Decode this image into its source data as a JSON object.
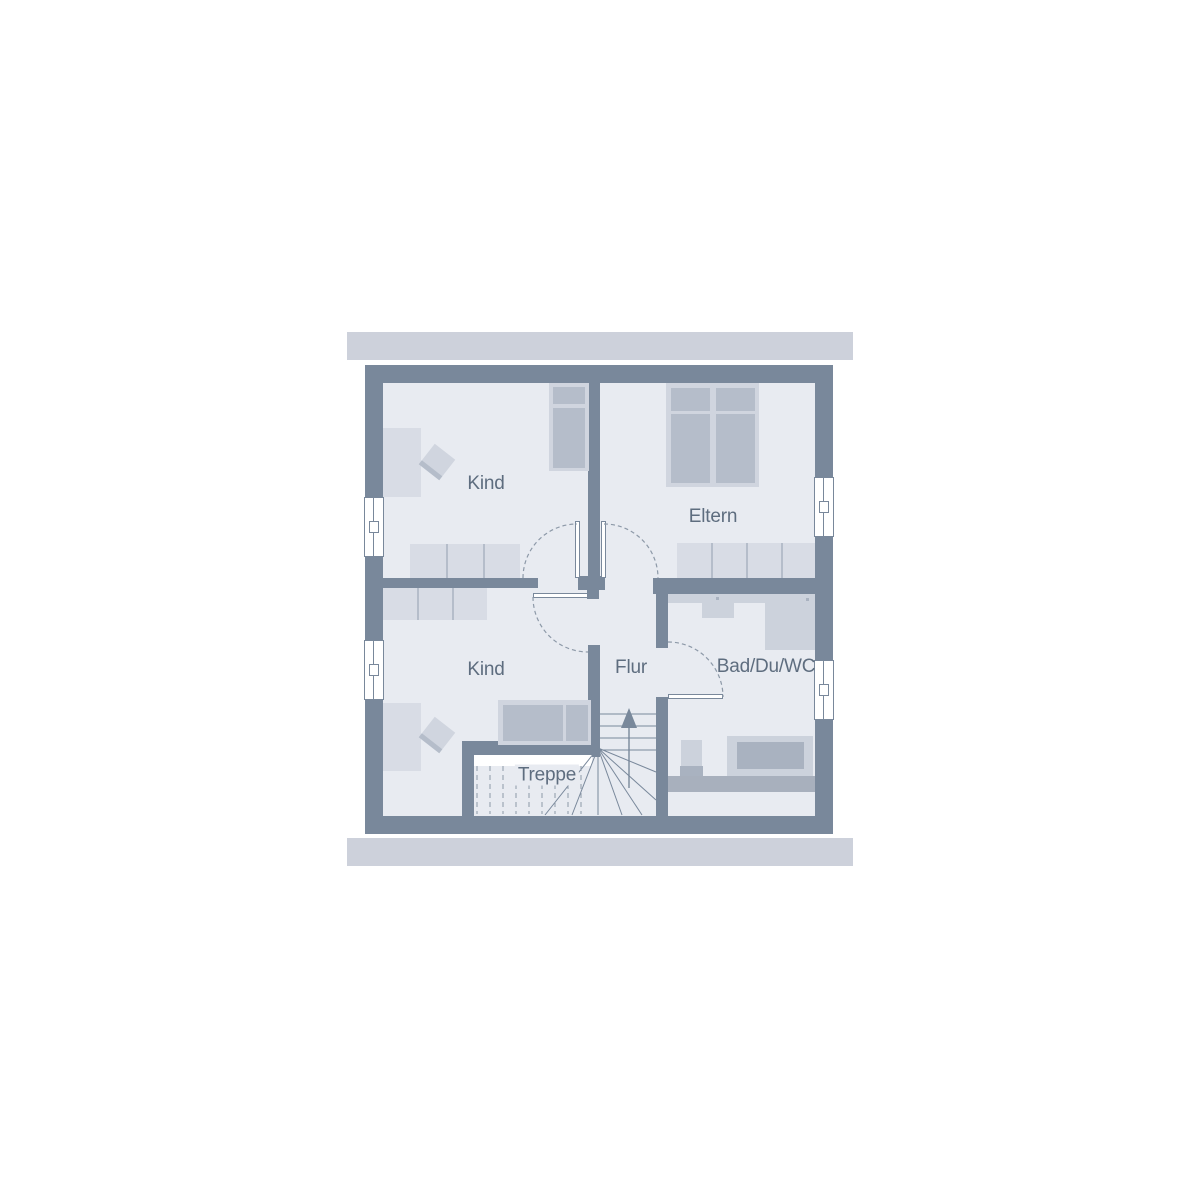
{
  "plan": {
    "title": "Dachgeschoss Grundriss",
    "rooms": [
      {
        "id": "kind-top",
        "label": "Kind"
      },
      {
        "id": "eltern",
        "label": "Eltern"
      },
      {
        "id": "kind-bottom",
        "label": "Kind"
      },
      {
        "id": "flur",
        "label": "Flur"
      },
      {
        "id": "bad-du-wc",
        "label": "Bad/Du/WC"
      },
      {
        "id": "treppe",
        "label": "Treppe"
      }
    ],
    "stairs": {
      "direction_arrow": "up"
    },
    "window_count": 4,
    "door_count": 4,
    "colors": {
      "wall": "#79889b",
      "roof_band": "#cdd1db",
      "floor": "#e8ebf1",
      "furniture_light": "#d8dce5",
      "furniture_frame": "#d0d5df",
      "furniture_dark": "#b5bdca",
      "fixture_light": "#ccd2dc",
      "fixture_dark": "#a9b2c0",
      "knee_wall": "#a8b0bd",
      "label_text": "#5e6d7f",
      "line": "#79889b",
      "dash_line": "#8d99a8"
    }
  }
}
